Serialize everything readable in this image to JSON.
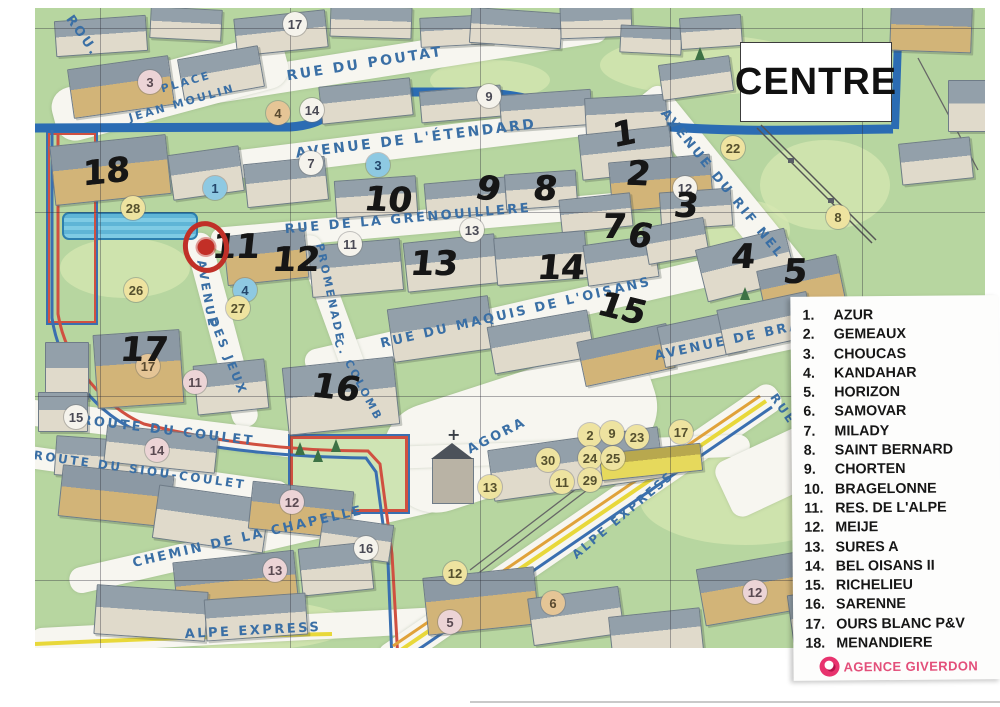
{
  "map": {
    "title": "CENTRE",
    "streets": [
      {
        "t": "ROU.",
        "p": [
          82,
          36
        ],
        "r": 55,
        "s": 13
      },
      {
        "t": "RUE DU POUTAT",
        "p": [
          365,
          64
        ],
        "r": -9,
        "s": 14
      },
      {
        "t": "PLACE",
        "p": [
          186,
          82
        ],
        "r": -16,
        "s": 11
      },
      {
        "t": "JEAN MOULIN",
        "p": [
          182,
          103
        ],
        "r": -16,
        "s": 11
      },
      {
        "t": "AVENUE DE L'ÉTENDARD",
        "p": [
          416,
          139
        ],
        "r": -7,
        "s": 14
      },
      {
        "t": "RUE DE LA GRENOUILLERE",
        "p": [
          408,
          219
        ],
        "r": -5,
        "s": 13
      },
      {
        "t": "RUE DU MAQUIS DE L'OISANS",
        "p": [
          516,
          313
        ],
        "r": -13,
        "s": 13
      },
      {
        "t": "AVENUE DU RIF NEL",
        "p": [
          722,
          184
        ],
        "r": 51,
        "s": 13
      },
      {
        "t": "AVENUE DE BRA",
        "p": [
          728,
          341
        ],
        "r": -12,
        "s": 13
      },
      {
        "t": "AVENUE",
        "p": [
          207,
          294
        ],
        "r": 80,
        "s": 12
      },
      {
        "t": "DES JEUX",
        "p": [
          228,
          356
        ],
        "r": 68,
        "s": 12
      },
      {
        "t": "PROMENADE",
        "p": [
          330,
          293
        ],
        "r": 78,
        "s": 11
      },
      {
        "t": "C. COLOMB",
        "p": [
          358,
          380
        ],
        "r": 62,
        "s": 11
      },
      {
        "t": "ROUTE DU COULET",
        "p": [
          168,
          431
        ],
        "r": 7,
        "s": 13
      },
      {
        "t": "ROUTE DU SIOU-COULET",
        "p": [
          140,
          470
        ],
        "r": 8,
        "s": 12
      },
      {
        "t": "CHEMIN DE LA CHAPELLE",
        "p": [
          248,
          537
        ],
        "r": -13,
        "s": 13
      },
      {
        "t": "AGORA",
        "p": [
          497,
          436
        ],
        "r": -27,
        "s": 13
      },
      {
        "t": "ALPE EXPRESS",
        "p": [
          253,
          631
        ],
        "r": -3,
        "s": 13
      },
      {
        "t": "ALPE EXPRESS",
        "p": [
          623,
          515
        ],
        "r": -40,
        "s": 12
      },
      {
        "t": "RUE",
        "p": [
          783,
          409
        ],
        "r": 55,
        "s": 12
      },
      {
        "t": "AM",
        "p": [
          933,
          637
        ],
        "r": -35,
        "s": 11
      }
    ],
    "printed_markers": [
      {
        "n": "3",
        "c": "pink",
        "p": [
          150,
          82
        ]
      },
      {
        "n": "17",
        "c": "white",
        "p": [
          295,
          24
        ]
      },
      {
        "n": "4",
        "c": "tan",
        "p": [
          278,
          113
        ]
      },
      {
        "n": "14",
        "c": "white",
        "p": [
          312,
          110
        ]
      },
      {
        "n": "7",
        "c": "white",
        "p": [
          311,
          163
        ]
      },
      {
        "n": "3",
        "c": "blue",
        "p": [
          378,
          165
        ]
      },
      {
        "n": "9",
        "c": "white",
        "p": [
          489,
          96
        ]
      },
      {
        "n": "1",
        "c": "blue",
        "p": [
          215,
          188
        ]
      },
      {
        "n": "28",
        "c": "yellow",
        "p": [
          133,
          208
        ]
      },
      {
        "n": "11",
        "c": "white",
        "p": [
          350,
          244
        ]
      },
      {
        "n": "13",
        "c": "white",
        "p": [
          472,
          230
        ]
      },
      {
        "n": "12",
        "c": "white",
        "p": [
          685,
          188
        ]
      },
      {
        "n": "22",
        "c": "yellow",
        "p": [
          733,
          148
        ]
      },
      {
        "n": "8",
        "c": "yellow",
        "p": [
          838,
          217
        ]
      },
      {
        "n": "26",
        "c": "yellow",
        "p": [
          136,
          290
        ]
      },
      {
        "n": "4",
        "c": "blue",
        "p": [
          245,
          290
        ]
      },
      {
        "n": "27",
        "c": "yellow",
        "p": [
          238,
          308
        ]
      },
      {
        "n": "17",
        "c": "tan",
        "p": [
          148,
          366
        ]
      },
      {
        "n": "11",
        "c": "pink",
        "p": [
          195,
          382
        ]
      },
      {
        "n": "15",
        "c": "white",
        "p": [
          76,
          417
        ]
      },
      {
        "n": "14",
        "c": "pink",
        "p": [
          157,
          450
        ]
      },
      {
        "n": "12",
        "c": "pink",
        "p": [
          292,
          502
        ]
      },
      {
        "n": "16",
        "c": "white",
        "p": [
          366,
          548
        ]
      },
      {
        "n": "13",
        "c": "pink",
        "p": [
          275,
          570
        ]
      },
      {
        "n": "12",
        "c": "yellow",
        "p": [
          455,
          573
        ]
      },
      {
        "n": "5",
        "c": "pink",
        "p": [
          450,
          622
        ]
      },
      {
        "n": "6",
        "c": "tan",
        "p": [
          553,
          603
        ]
      },
      {
        "n": "12",
        "c": "pink",
        "p": [
          755,
          592
        ]
      },
      {
        "n": "13",
        "c": "yellow",
        "p": [
          490,
          487
        ]
      },
      {
        "n": "2",
        "c": "yellow",
        "p": [
          590,
          435
        ]
      },
      {
        "n": "9",
        "c": "yellow",
        "p": [
          612,
          433
        ]
      },
      {
        "n": "23",
        "c": "yellow",
        "p": [
          637,
          437
        ]
      },
      {
        "n": "17",
        "c": "yellow",
        "p": [
          681,
          432
        ]
      },
      {
        "n": "30",
        "c": "yellow",
        "p": [
          548,
          460
        ]
      },
      {
        "n": "24",
        "c": "yellow",
        "p": [
          590,
          458
        ]
      },
      {
        "n": "25",
        "c": "yellow",
        "p": [
          613,
          458
        ]
      },
      {
        "n": "11",
        "c": "yellow",
        "p": [
          562,
          482
        ]
      },
      {
        "n": "29",
        "c": "yellow",
        "p": [
          590,
          480
        ]
      }
    ],
    "handwritten": [
      {
        "n": "18",
        "p": [
          106,
          172
        ],
        "r": -6
      },
      {
        "n": "10",
        "p": [
          388,
          200
        ],
        "r": 2
      },
      {
        "n": "9",
        "p": [
          488,
          189
        ],
        "r": 10
      },
      {
        "n": "8",
        "p": [
          545,
          189
        ],
        "r": 2
      },
      {
        "n": "1",
        "p": [
          624,
          134
        ],
        "r": -12
      },
      {
        "n": "2",
        "p": [
          638,
          174
        ],
        "r": 2
      },
      {
        "n": "3",
        "p": [
          686,
          206
        ],
        "r": 2
      },
      {
        "n": "7",
        "p": [
          614,
          227
        ],
        "r": 0
      },
      {
        "n": "6",
        "p": [
          640,
          236
        ],
        "r": 8
      },
      {
        "n": "4",
        "p": [
          743,
          257
        ],
        "r": 0
      },
      {
        "n": "5",
        "p": [
          795,
          272
        ],
        "r": 0
      },
      {
        "n": "11",
        "p": [
          236,
          247
        ],
        "r": 0
      },
      {
        "n": "12",
        "p": [
          296,
          260
        ],
        "r": 0
      },
      {
        "n": "13",
        "p": [
          434,
          264
        ],
        "r": 0
      },
      {
        "n": "14",
        "p": [
          561,
          268
        ],
        "r": 0
      },
      {
        "n": "15",
        "p": [
          622,
          309
        ],
        "r": 14
      },
      {
        "n": "16",
        "p": [
          336,
          388
        ],
        "r": 6
      },
      {
        "n": "17",
        "p": [
          144,
          350
        ],
        "r": 0
      }
    ],
    "icons": [
      {
        "k": "lift",
        "v": "yellowcircle",
        "p": [
          132,
          102
        ]
      },
      {
        "k": "recycle",
        "p": [
          245,
          88
        ]
      },
      {
        "k": "recycle",
        "p": [
          553,
          99
        ]
      },
      {
        "k": "recycle",
        "p": [
          643,
          62
        ]
      },
      {
        "k": "recycle",
        "p": [
          635,
          14
        ]
      },
      {
        "k": "heart",
        "p": [
          253,
          110
        ]
      },
      {
        "k": "people",
        "p": [
          158,
          210
        ]
      },
      {
        "k": "heart",
        "p": [
          148,
          233
        ]
      },
      {
        "k": "recycle",
        "p": [
          173,
          235
        ]
      },
      {
        "k": "pharmacy",
        "p": [
          226,
          288
        ]
      },
      {
        "k": "plug",
        "p": [
          183,
          305
        ]
      },
      {
        "k": "skier",
        "p": [
          162,
          270
        ]
      },
      {
        "k": "skier",
        "p": [
          177,
          274
        ]
      },
      {
        "k": "people",
        "p": [
          123,
          322
        ]
      },
      {
        "k": "heart",
        "p": [
          152,
          322
        ]
      },
      {
        "k": "parking",
        "p": [
          305,
          135
        ]
      },
      {
        "k": "parking",
        "p": [
          172,
          345
        ]
      },
      {
        "k": "recycle",
        "p": [
          190,
          333
        ]
      },
      {
        "k": "recycle",
        "p": [
          97,
          397
        ]
      },
      {
        "k": "med",
        "p": [
          712,
          120
        ]
      },
      {
        "k": "recycle",
        "p": [
          804,
          213
        ]
      },
      {
        "k": "lift",
        "v": "bluesign",
        "p": [
          875,
          222
        ]
      },
      {
        "k": "skier",
        "p": [
          857,
          252
        ]
      },
      {
        "k": "skier",
        "p": [
          920,
          155
        ]
      },
      {
        "k": "recycle",
        "p": [
          903,
          42
        ]
      },
      {
        "k": "parking",
        "p": [
          360,
          520
        ]
      },
      {
        "k": "basket",
        "p": [
          385,
          520
        ]
      },
      {
        "k": "recycle",
        "p": [
          313,
          543
        ]
      },
      {
        "k": "heart",
        "p": [
          297,
          573
        ]
      },
      {
        "k": "recycle",
        "p": [
          478,
          573
        ]
      },
      {
        "k": "recycle",
        "p": [
          42,
          565
        ]
      },
      {
        "k": "sled",
        "p": [
          115,
          627
        ]
      },
      {
        "k": "lift",
        "v": "bluesign",
        "p": [
          147,
          627
        ]
      },
      {
        "k": "wc",
        "p": [
          543,
          417
        ]
      },
      {
        "k": "people",
        "p": [
          570,
          415
        ]
      },
      {
        "k": "lift",
        "v": "yellowcircle",
        "p": [
          533,
          437
        ]
      },
      {
        "k": "heart",
        "p": [
          560,
          440
        ]
      },
      {
        "k": "heart",
        "p": [
          518,
          458
        ]
      },
      {
        "k": "recycle",
        "p": [
          485,
          465
        ]
      },
      {
        "k": "parking",
        "p": [
          665,
          388
        ]
      },
      {
        "k": "recycle",
        "p": [
          698,
          394
        ]
      },
      {
        "k": "wc",
        "p": [
          712,
          424
        ]
      },
      {
        "k": "skier",
        "p": [
          777,
          370
        ]
      },
      {
        "k": "vehicle",
        "p": [
          708,
          446
        ]
      }
    ]
  },
  "legend": {
    "items": [
      {
        "num": "1.",
        "label": "AZUR"
      },
      {
        "num": "2.",
        "label": "GEMEAUX"
      },
      {
        "num": "3.",
        "label": "CHOUCAS"
      },
      {
        "num": "4.",
        "label": "KANDAHAR"
      },
      {
        "num": "5.",
        "label": "HORIZON"
      },
      {
        "num": "6.",
        "label": "SAMOVAR"
      },
      {
        "num": "7.",
        "label": "MILADY"
      },
      {
        "num": "8.",
        "label": "SAINT BERNARD"
      },
      {
        "num": "9.",
        "label": "CHORTEN"
      },
      {
        "num": "10.",
        "label": "BRAGELONNE"
      },
      {
        "num": "11.",
        "label": "RES. DE L'ALPE"
      },
      {
        "num": "12.",
        "label": "MEIJE"
      },
      {
        "num": "13.",
        "label": "SURES A"
      },
      {
        "num": "14.",
        "label": "BEL OISANS II"
      },
      {
        "num": "15.",
        "label": "RICHELIEU"
      },
      {
        "num": "16.",
        "label": "SARENNE"
      },
      {
        "num": "17.",
        "label": "OURS BLANC P&V"
      },
      {
        "num": "18.",
        "label": "MENANDIERE"
      }
    ],
    "agency": "AGENCE GIVERDON"
  }
}
